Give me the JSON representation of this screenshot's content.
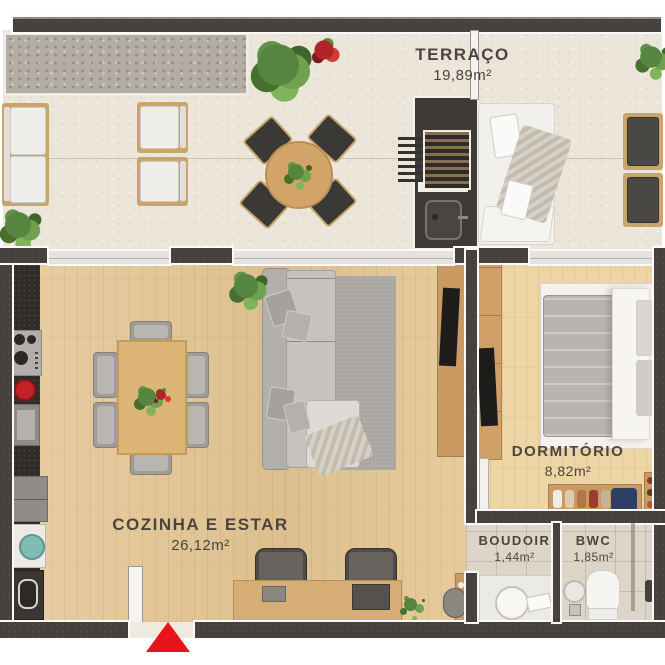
{
  "plan_title": "Apartment floor plan",
  "rooms": [
    {
      "name": "TERRAÇO",
      "area": "19,89m²"
    },
    {
      "name": "COZINHA E ESTAR",
      "area": "26,12m²"
    },
    {
      "name": "DORMITÓRIO",
      "area": "8,82m²"
    },
    {
      "name": "BOUDOIR",
      "area": "1,44m²"
    },
    {
      "name": "BWC",
      "area": "1,85m²"
    }
  ],
  "markers": {
    "entrance": "red triangle arrow at main door"
  },
  "colors": {
    "wall": "#46413d",
    "wall_outline": "#fbfaf8",
    "terrace_floor": "#ebe5da",
    "living_wood_floor": "#e6c795",
    "bedroom_wood_floor": "#eed5a5",
    "bathroom_tile": "#ddd5c8",
    "label_text": "#4b453f",
    "entrance_red": "#e8131b",
    "furniture_wood": "#c9a56c",
    "sofa_gray": "#c6c3bf"
  }
}
